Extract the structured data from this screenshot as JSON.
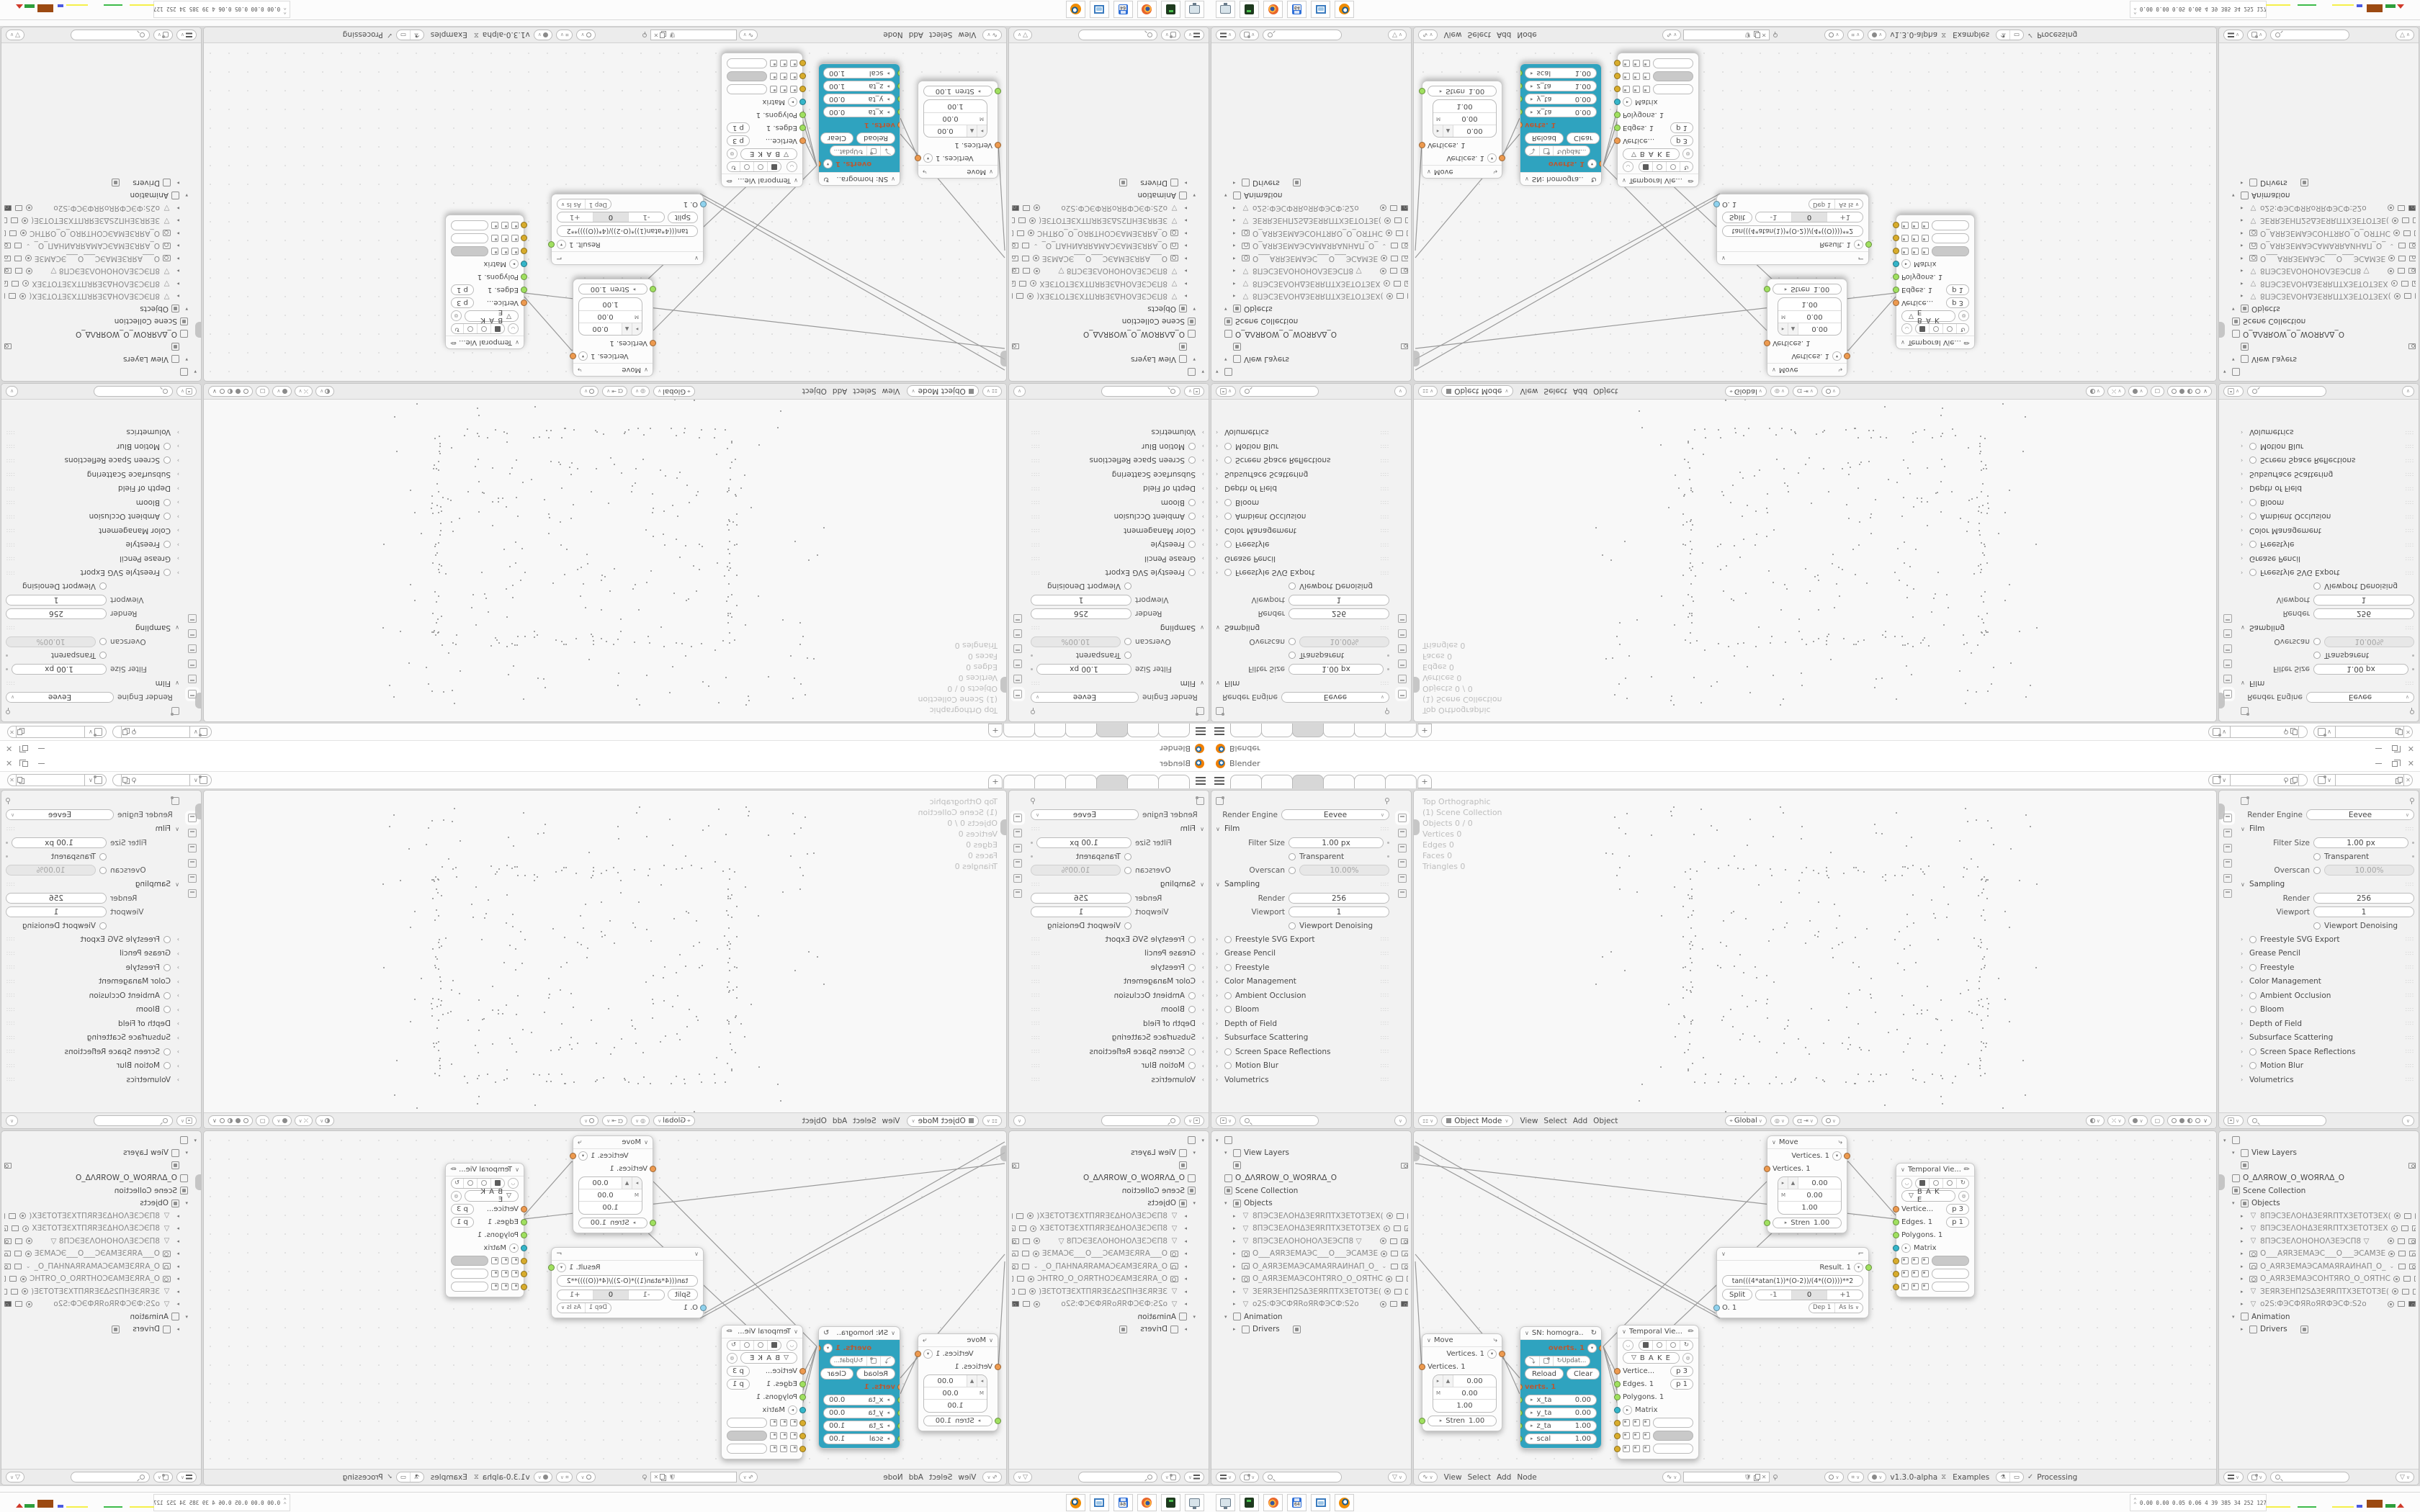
{
  "window": {
    "title": "Blender"
  },
  "topbar": {
    "tabs": [
      {
        "label": ""
      },
      {
        "label": ""
      },
      {
        "label": "",
        "active": true
      },
      {
        "label": ""
      },
      {
        "label": ""
      },
      {
        "label": ""
      }
    ],
    "new_tab_label": "+"
  },
  "properties": {
    "render_engine_label": "Render Engine",
    "render_engine_value": "Eevee",
    "film": {
      "title": "Film",
      "filter_size_label": "Filter Size",
      "filter_size_value": "1.00 px",
      "transparent_label": "Transparent",
      "overscan_label": "Overscan",
      "overscan_value": "10.00%"
    },
    "sampling": {
      "title": "Sampling",
      "render_label": "Render",
      "render_value": "256",
      "viewport_label": "Viewport",
      "viewport_value": "1",
      "denoise_label": "Viewport Denoising"
    },
    "collapsed_sections": [
      {
        "label": "Freestyle SVG Export",
        "cb": true
      },
      {
        "label": "Grease Pencil",
        "cb": false
      },
      {
        "label": "Freestyle",
        "cb": true
      },
      {
        "label": "Color Management",
        "cb": false
      },
      {
        "label": "Ambient Occlusion",
        "cb": true
      },
      {
        "label": "Bloom",
        "cb": true
      },
      {
        "label": "Depth of Field",
        "cb": false
      },
      {
        "label": "Subsurface Scattering",
        "cb": false
      },
      {
        "label": "Screen Space Reflections",
        "cb": true
      },
      {
        "label": "Motion Blur",
        "cb": true
      },
      {
        "label": "Volumetrics",
        "cb": false
      }
    ]
  },
  "outliner": {
    "view_layers_label": "View Layers",
    "world_name": "O_ΔΛЯROW_O_WOЯRΛΔ_O",
    "scene_collection_label": "Scene Collection",
    "objects_label": "Objects",
    "animation_label": "Animation",
    "drivers_label": "Drivers",
    "objects": [
      {
        "type": "mesh",
        "name": "8ПЭСЗЕΛОНΔЗЕЯRПТХЗЕТОТЗЕХ(",
        "eye": "eye",
        "camf": false
      },
      {
        "type": "mesh",
        "name": "8ПЭСЗЕΛОНΔЗЕЯRПТХЗЕТОТЗЕХ",
        "eye": "eye",
        "camf": false
      },
      {
        "type": "mesh",
        "name": "8ПЭСЗЕΛОНОНОΛЗЕЭСП8    ▽",
        "eye": "eye",
        "camf": false
      },
      {
        "type": "camera",
        "name": "О___АЯRЗЕМАЭС___О___ЭСАМЗЕ",
        "eye": "eye",
        "camf": false
      },
      {
        "type": "camera",
        "name": "О_АЯRЗЕМАЭСАМАЯRАИНАП_О_",
        "eye": "chev",
        "camf": false
      },
      {
        "type": "camera",
        "name": "О_АЯRЗЕМАЭСОНТЯRО_О_ОЯТНС",
        "eye": "eye",
        "camf": false
      },
      {
        "type": "mesh",
        "name": "ЗЕЯRЗЕНП2SΔЗЕЯRПТХЗЕТОТЗЕ(",
        "eye": "eye",
        "camf": false
      },
      {
        "type": "mesh",
        "name": "о2S:ФЭСФЯRоЯRФЭСФ:S2о",
        "eye": "eye",
        "camf": true
      }
    ]
  },
  "viewport": {
    "overlay_lines": [
      {
        "text": "Top Orthographic"
      },
      {
        "text": "(1) Scene Collection"
      },
      {
        "text": "Objects    0 / 0"
      },
      {
        "text": "Vertices    0"
      },
      {
        "text": "Edges    0"
      },
      {
        "text": "Faces    0"
      },
      {
        "text": "Triangles    0"
      }
    ],
    "header": {
      "mode_value": "Object Mode",
      "menus": [
        {
          "label": "View"
        },
        {
          "label": "Select"
        },
        {
          "label": "Add"
        },
        {
          "label": "Object"
        }
      ],
      "orientation_value": "Global"
    }
  },
  "node_editor": {
    "header": {
      "menus": [
        {
          "label": "View"
        },
        {
          "label": "Select"
        },
        {
          "label": "Add"
        },
        {
          "label": "Node"
        }
      ],
      "version": "v1.3.0-alpha",
      "examples_label": "Examples",
      "processing_label": "Processing",
      "check": "✓"
    },
    "nodes": {
      "move": {
        "title": "Move",
        "out_label": "Vertices. 1",
        "in_label": "Vertices. 1",
        "v1": "0.00",
        "v2": "0.00",
        "v3": "1.00",
        "m": "M",
        "stren_label": "Stren",
        "stren_value": "1.00"
      },
      "homogra": {
        "title": "SN: homogra..",
        "out_label": "overts. 1",
        "update_label": "Updat...",
        "reload_label": "Reload",
        "clear_label": "Clear",
        "in_label": "verts. 1",
        "fields": [
          {
            "k": "x_ta",
            "v": "0.00"
          },
          {
            "k": "y_ta",
            "v": "0.00"
          },
          {
            "k": "z_ta",
            "v": "1.00"
          },
          {
            "k": "scal",
            "v": "1.00"
          }
        ]
      },
      "temporal": {
        "title": "Temporal Vie...",
        "bake_label": "B A K E",
        "vertice_label": "Vertice...",
        "vertice_badge": "p  3",
        "edges_label": "Edges. 1",
        "edges_badge": "p  1",
        "polygons_label": "Polygons. 1",
        "matrix_label": "Matrix"
      },
      "formula": {
        "result_label": "Result. 1",
        "formula_value": "tan(((4*atan(1))*(O-2))/(4*((O))))**2",
        "split_label": "Split",
        "segments": [
          {
            "label": "-1"
          },
          {
            "label": "0",
            "active": true
          },
          {
            "label": "+1"
          }
        ],
        "o_label": "O. 1",
        "dep_value": "Dep  1",
        "wrap_value": "As Is"
      }
    },
    "wires": [
      [
        2,
        15,
        419,
        253
      ],
      [
        2,
        30,
        425,
        260
      ],
      [
        2,
        45,
        669,
        122
      ],
      [
        2,
        171,
        147,
        343
      ],
      [
        2,
        181,
        11,
        329
      ],
      [
        123,
        311,
        147,
        365
      ],
      [
        263,
        299,
        490,
        70
      ],
      [
        603,
        42,
        284,
        342
      ],
      [
        603,
        42,
        670,
        118
      ],
      [
        263,
        299,
        284,
        342
      ],
      [
        263,
        299,
        284,
        366
      ],
      [
        263,
        299,
        284,
        384
      ]
    ]
  },
  "taskbar": {
    "stats": "0.00 0.00 0.05 0.06  4  39 385 34 252 127 1.5 3.0 34 29 3825 4577",
    "icons": [
      "display-settings",
      "disk-tool",
      "firefox",
      "installer-64",
      "screenshot-tool",
      "blender"
    ]
  },
  "colors": {
    "teal_node": "#2fa3bf",
    "socket_orange": "#ed9a4f",
    "socket_green": "#a0e060",
    "socket_cyan": "#35b5c9",
    "socket_yellow": "#d8ac2c",
    "socket_blue": "#8fd2ee"
  }
}
